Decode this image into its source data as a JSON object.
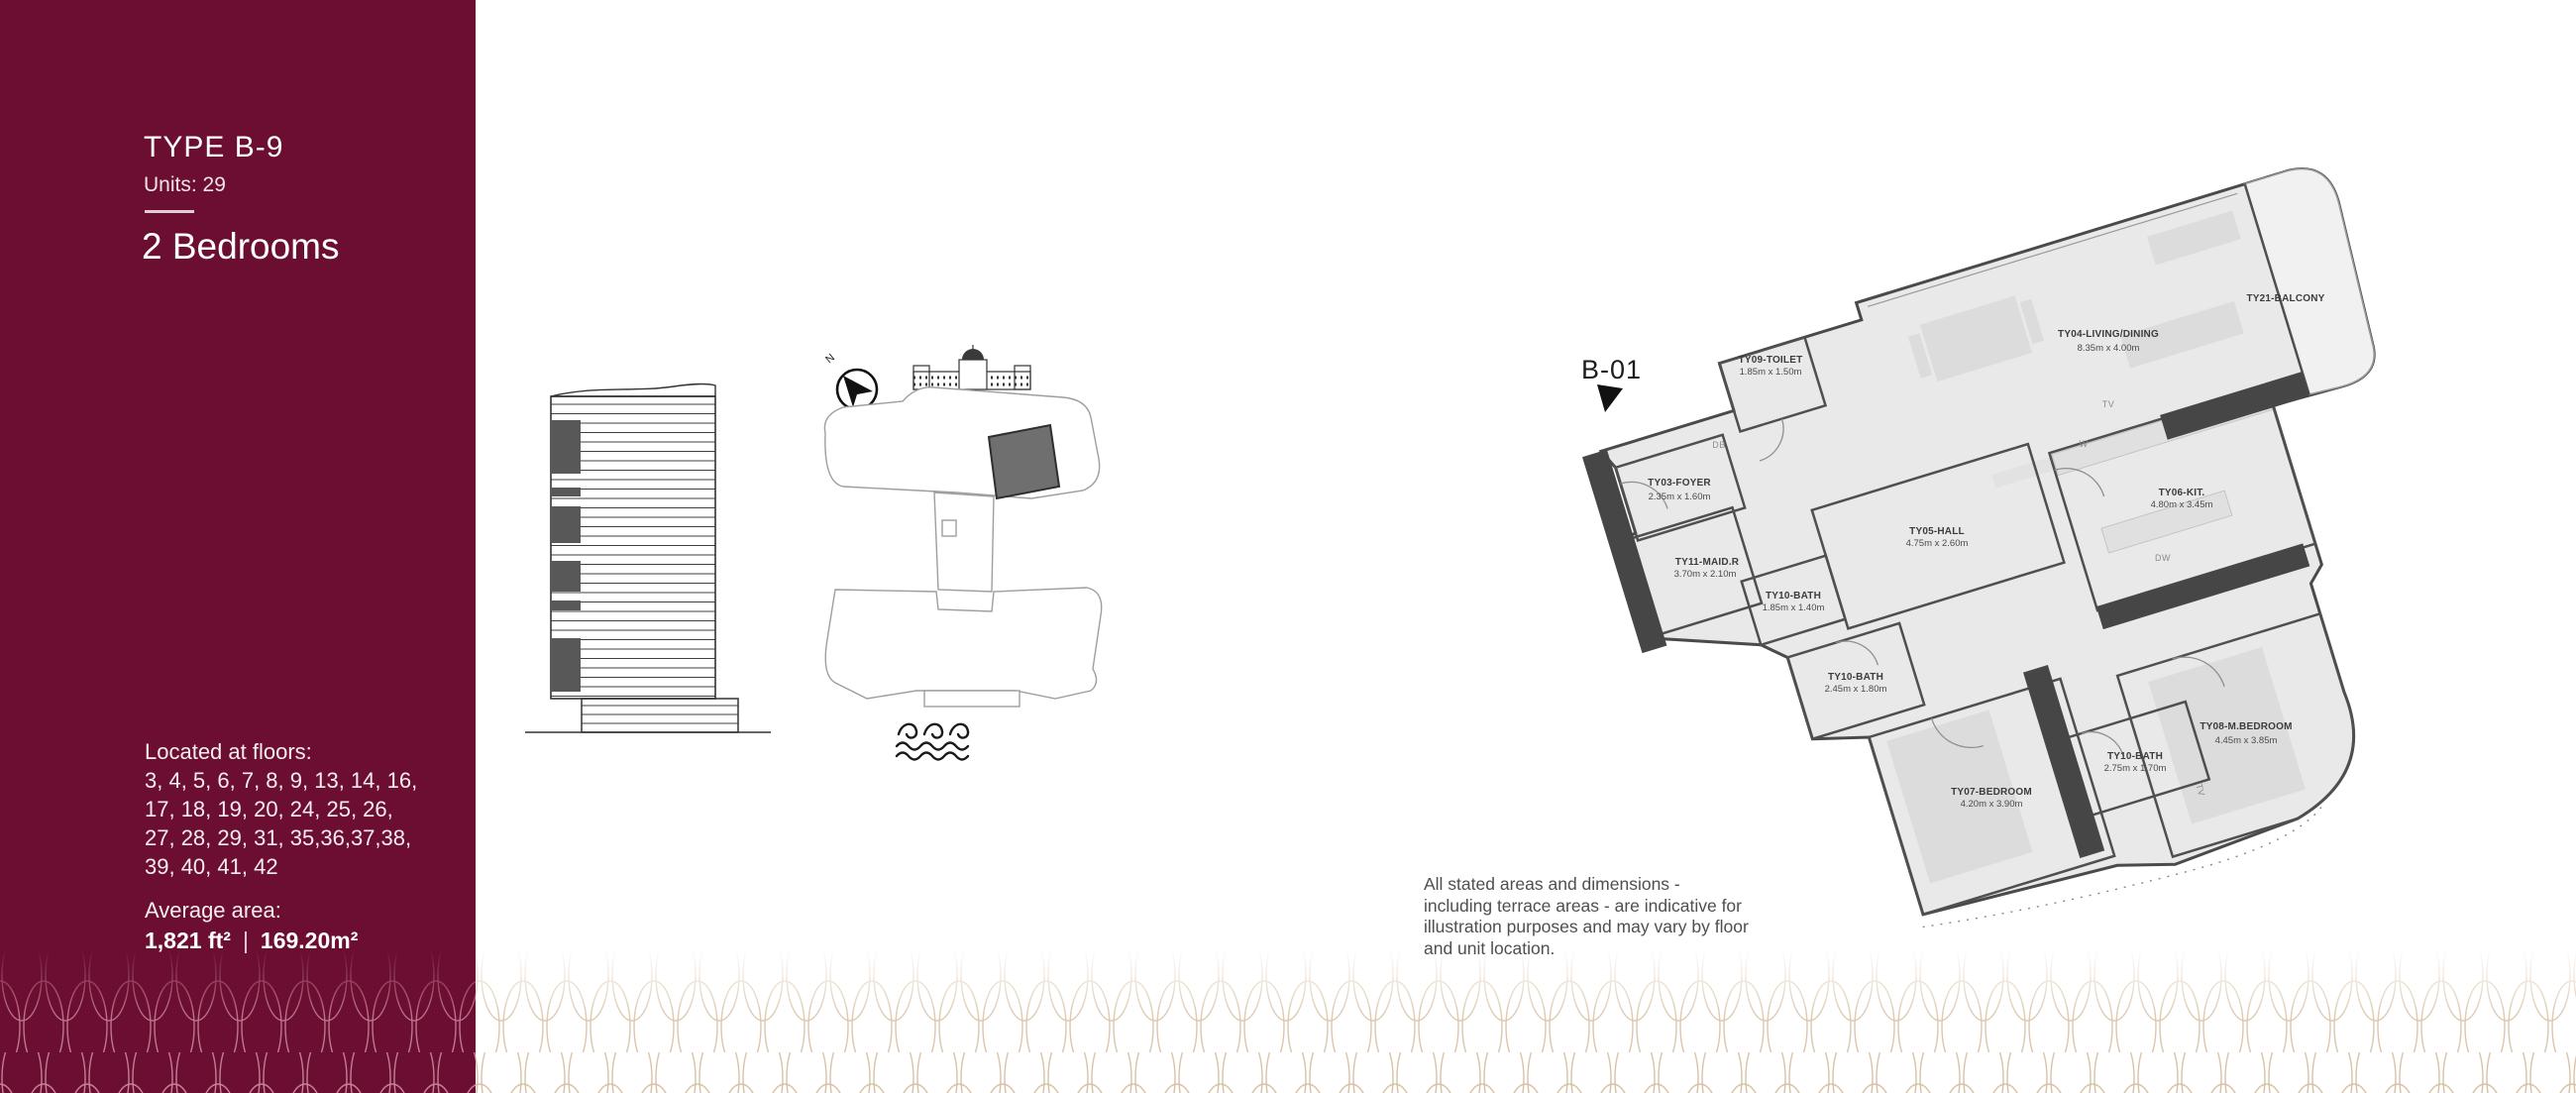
{
  "colors": {
    "sidebar_bg": "#6C0E31",
    "pattern_on_white": "#D8BFA3",
    "pattern_on_maroon": "#C8849B",
    "unit_highlight": "#6F6F6F",
    "wall_dark": "#464646"
  },
  "sidebar": {
    "type_title": "TYPE B-9",
    "units": "Units: 29",
    "bedrooms": "2 Bedrooms",
    "floors_label": "Located at floors:",
    "floors_lines": [
      "3, 4, 5, 6, 7, 8, 9, 13, 14, 16,",
      "17, 18, 19, 20, 24, 25, 26,",
      "27, 28, 29, 31, 35,36,37,38,",
      "39, 40, 41, 42"
    ],
    "avg_label": "Average area:",
    "area_ft": "1,821 ft²",
    "area_sep": "|",
    "area_m": "169.20m²"
  },
  "keyplan": {
    "north_label": "N"
  },
  "plan": {
    "unit_label": "B-01",
    "rooms": [
      {
        "name": "TY03-FOYER",
        "dims": "2.35m x 1.60m"
      },
      {
        "name": "TY09-TOILET",
        "dims": "1.85m x 1.50m"
      },
      {
        "name": "TY04-LIVING/DINING",
        "dims": "8.35m x 4.00m"
      },
      {
        "name": "TY21-BALCONY",
        "dims": ""
      },
      {
        "name": "TY05-HALL",
        "dims": "4.75m x 2.60m"
      },
      {
        "name": "TY06-KIT.",
        "dims": "4.80m x 3.45m"
      },
      {
        "name": "TY11-MAID.R",
        "dims": "3.70m x 2.10m"
      },
      {
        "name": "TY10-BATH",
        "dims": "1.85m x 1.40m"
      },
      {
        "name": "TY10-BATH",
        "dims": "2.45m x 1.80m"
      },
      {
        "name": "TY10-BATH",
        "dims": "2.75m x 1.70m"
      },
      {
        "name": "TY07-BEDROOM",
        "dims": "4.20m x 3.90m"
      },
      {
        "name": "TY08-M.BEDROOM",
        "dims": "4.45m x 3.85m"
      }
    ],
    "appliances": {
      "db": "DB",
      "w": "W",
      "tv": "TV",
      "dw": "DW",
      "tv2": "TV"
    }
  },
  "disclaimer": {
    "lines": [
      "All stated areas and dimensions -",
      "including terrace areas - are indicative for",
      "illustration purposes and may vary by floor",
      "and unit location."
    ]
  }
}
